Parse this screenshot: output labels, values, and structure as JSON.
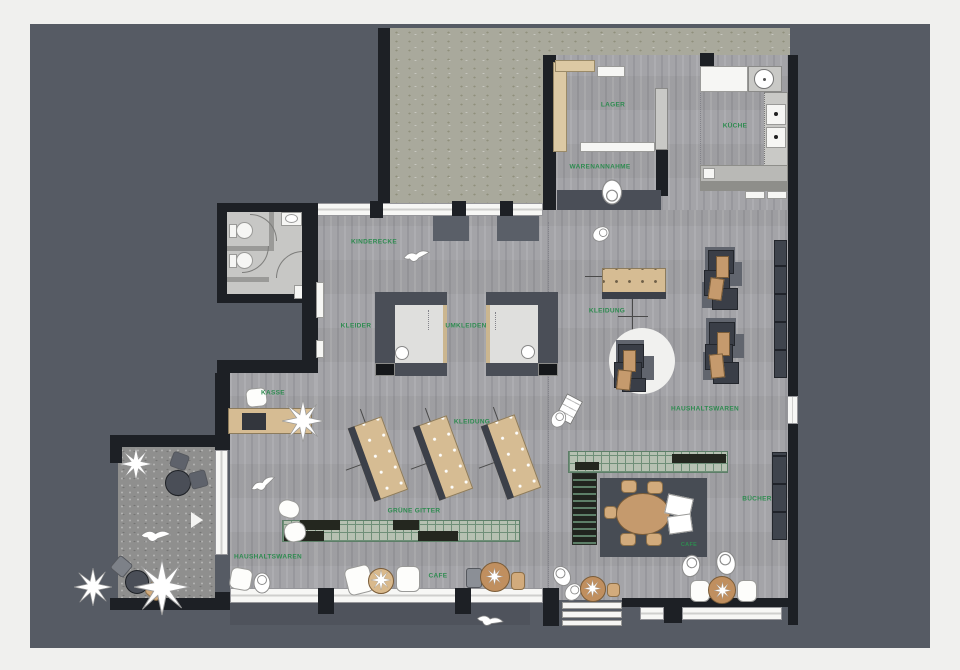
{
  "plan": {
    "type": "retail-store-floorplan",
    "language": "de"
  },
  "labels": {
    "lager": "LAGER",
    "kueche": "KÜCHE",
    "warenannahme": "WARENANNAHME",
    "kinderecke": "KINDERECKE",
    "kleider": "KLEIDER",
    "umkleiden": "UMKLEIDEN",
    "kleidung_right": "KLEIDUNG",
    "kleidung_center": "KLEIDUNG",
    "haushaltswaren_right": "HAUSHALTSWAREN",
    "haushaltswaren_left": "HAUSHALTSWAREN",
    "kasse": "KASSE",
    "gruene_gitter": "GRÜNE GITTER",
    "cafe": "CAFE",
    "cafe_rug": "CAFE",
    "buecher": "BÜCHER"
  },
  "colors": {
    "frame": "#f0f0ee",
    "background": "#565b64",
    "wall": "#1d2025",
    "floor": "#a4a4a8",
    "concrete_courtyard": "#a9a99c",
    "terrace": "#8f8f8e",
    "label_green": "#2e8b50",
    "wood_furniture": "#d6bc93",
    "sofa_dark": "#3a3e47",
    "cushion_tan": "#c59a6d",
    "cafe_rug": "#474c54",
    "grid_green": "#6f8f78"
  }
}
